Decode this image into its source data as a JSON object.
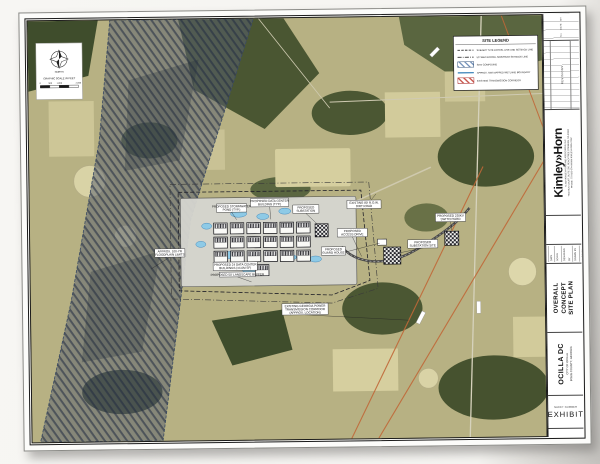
{
  "title_block": {
    "rev_header": {
      "no": "No.",
      "revisions": "REVISIONS",
      "date": "DATE",
      "by": "BY"
    },
    "logo": {
      "name": "Kimley»Horn",
      "sub1": "© 2024 KIMLEY-HORN AND ASSOCIATES, INC.",
      "sub2": "TWO SUN COURT, SUITE 200, PEACHTREE CORNERS, GA 30092",
      "sub3": "PHONE: 770-825-0744   WWW.KIMLEY-HORN.COM"
    },
    "info_rows": [
      "PROJECT NO.",
      "DATE",
      "SCALE",
      "DESIGNED BY",
      "DRAWN BY",
      "CHECKED BY"
    ],
    "sheet_title": {
      "line1": "OVERALL CONCEPT",
      "line2": "SITE PLAN"
    },
    "project": {
      "name": "OCILLA DC",
      "sub1": "CITY OF OCILLA",
      "sub2": "IRWIN COUNTY, GEORGIA"
    },
    "sheet_number": {
      "label": "SHEET NUMBER",
      "value": "EXHIBIT"
    }
  },
  "map": {
    "north_label": "NORTH",
    "scale_title": "GRAPHIC SCALE IN FEET",
    "scale_ticks": [
      "0",
      "500",
      "1,000",
      "2,000"
    ],
    "legend": {
      "title": "SITE LEGEND",
      "entries": [
        {
          "label": "SUBJECT SITE PARCEL LINE AND SETBACK LINE"
        },
        {
          "label": "50' SEMI PARCEL SIDE/REAR SETBACK LINE"
        },
        {
          "label": "SITE COMPOUND"
        },
        {
          "label": "APPROX. NWI MAPPED WETLAND BOUNDARY"
        },
        {
          "label": "EXISTING TRANSMISSION CORRIDOR"
        }
      ]
    },
    "callouts": [
      {
        "line1": "PROPOSED STORMWATER",
        "line2": "POND (TYP.)"
      },
      {
        "line1": "PROPOSED DATA CENTER",
        "line2": "BUILDING (TYP.)"
      },
      {
        "line1": "PROPOSED",
        "line2": "SUBSTATION"
      },
      {
        "line1": "PROPOSED 24 DATA CENTER",
        "line2": "BUILDINGS (±4.0M SF)"
      },
      {
        "line1": "PROPOSED 50' LANDSCAPE BUFFER"
      },
      {
        "line1": "APPROX. 100-YR",
        "line2": "FLOODPLAIN LIMITS"
      },
      {
        "line1": "EXISTING GEORGIA POWER",
        "line2": "TRANSMISSION CORRIDOR",
        "line3": "(APPROX. LOCATION)"
      },
      {
        "line1": "EXISTING 80' R.O.W.",
        "line2": "DIRT ROAD"
      },
      {
        "line1": "PROPOSED",
        "line2": "ACCESS DRIVE"
      },
      {
        "line1": "PROPOSED",
        "line2": "SUBSTATION SITE"
      },
      {
        "line1": "PROPOSED 230KV",
        "line2": "SWITCHYARD"
      },
      {
        "line1": "PROPOSED",
        "line2": "GUARD HOUSE"
      }
    ]
  },
  "colors": {
    "aerial_base": "#B7B183",
    "floodplain_hatch": "#46536B",
    "wetland_blue": "#8ECAE6",
    "transmission_orange": "#C06838",
    "legend_red": "#C0392B"
  }
}
